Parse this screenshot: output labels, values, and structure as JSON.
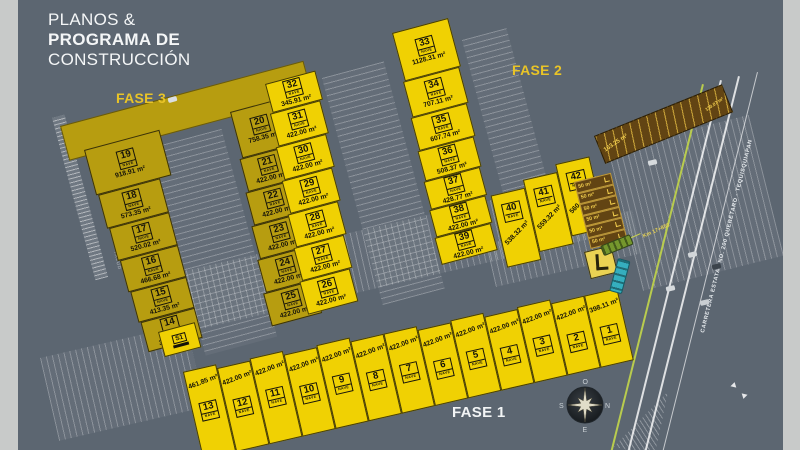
{
  "canvas": {
    "bg": "#5c6671",
    "side_rail": "#c8cac9"
  },
  "title": {
    "line1": "PLANOS &",
    "line2": "PROGRAMA DE",
    "line3": "CONSTRUCCIÓN"
  },
  "phase_labels": {
    "fase1": "FASE 1",
    "fase2": "FASE 2",
    "fase3": "FASE 3"
  },
  "badge_label": "NAVE",
  "colors": {
    "olive_lot": "#b79d10",
    "yellow_lot": "#f0d103",
    "brown_lot": "#624413",
    "accent": "#e9c427"
  },
  "lots": {
    "fase3_col": [
      {
        "num": "19",
        "area": "918.91 m²"
      },
      {
        "num": "18",
        "area": "573.35 m²"
      },
      {
        "num": "17",
        "area": "520.02 m²"
      },
      {
        "num": "16",
        "area": "466.68 m²"
      },
      {
        "num": "15",
        "area": "413.35 m²"
      },
      {
        "num": "14",
        "area": "360.01 m²"
      }
    ],
    "s1": {
      "num": "S1"
    },
    "mid_left_col": [
      {
        "num": "20",
        "area": "758.35 m²"
      },
      {
        "num": "21",
        "area": "422.00 m²"
      },
      {
        "num": "22",
        "area": "422.00 m²"
      },
      {
        "num": "23",
        "area": "422.00 m²"
      },
      {
        "num": "24",
        "area": "422.00 m²"
      },
      {
        "num": "25",
        "area": "422.00 m²"
      }
    ],
    "mid_right_col": [
      {
        "num": "32",
        "area": "345.91 m²"
      },
      {
        "num": "31",
        "area": "422.00 m²"
      },
      {
        "num": "30",
        "area": "422.00 m²"
      },
      {
        "num": "29",
        "area": "422.00 m²"
      },
      {
        "num": "28",
        "area": "422.00 m²"
      },
      {
        "num": "27",
        "area": "422.00 m²"
      },
      {
        "num": "26",
        "area": "422.00 m²"
      }
    ],
    "east_col": [
      {
        "num": "33",
        "area": "1128.31 m²"
      },
      {
        "num": "34",
        "area": "707.11 m²"
      },
      {
        "num": "35",
        "area": "607.74 m²"
      },
      {
        "num": "36",
        "area": "508.37 m²"
      },
      {
        "num": "37",
        "area": "428.77 m²"
      },
      {
        "num": "38",
        "area": "422.00 m²"
      },
      {
        "num": "39",
        "area": "422.00 m²"
      }
    ],
    "block_40s": [
      {
        "num": "40",
        "area": "538.32 m²"
      },
      {
        "num": "41",
        "area": "559.32 m²"
      },
      {
        "num": "42",
        "area": "560.32 m²"
      }
    ],
    "fase1_row": [
      {
        "num": "13",
        "area": "461.85 m²"
      },
      {
        "num": "12",
        "area": "422.00 m²"
      },
      {
        "num": "11",
        "area": "422.00 m²"
      },
      {
        "num": "10",
        "area": "422.00 m²"
      },
      {
        "num": "9",
        "area": "422.00 m²"
      },
      {
        "num": "8",
        "area": "422.00 m²"
      },
      {
        "num": "7",
        "area": "422.00 m²"
      },
      {
        "num": "6",
        "area": "422.00 m²"
      },
      {
        "num": "5",
        "area": "422.00 m²"
      },
      {
        "num": "4",
        "area": "422.00 m²"
      },
      {
        "num": "3",
        "area": "422.00 m²"
      },
      {
        "num": "2",
        "area": "422.00 m²"
      },
      {
        "num": "1",
        "area": "398.11 m²"
      }
    ],
    "strip_left_label": "163.25 m²",
    "strip_right_label": "130.07 m²",
    "small_lots": [
      {
        "area": "50 m²"
      },
      {
        "area": "50 m²"
      },
      {
        "area": "50 m²"
      },
      {
        "area": "50 m²"
      },
      {
        "area": "50 m²"
      },
      {
        "area": "50 m²"
      }
    ]
  },
  "road": {
    "name": "CARRETERA ESTATAL NO. 200 QUERÉTARO - TEQUISQUIAPAN",
    "km": "Km 17+850"
  },
  "compass": {
    "top": "O",
    "right": "N",
    "bottom": "E",
    "left": "S"
  },
  "annotations": {
    "talud": "TALUD"
  }
}
